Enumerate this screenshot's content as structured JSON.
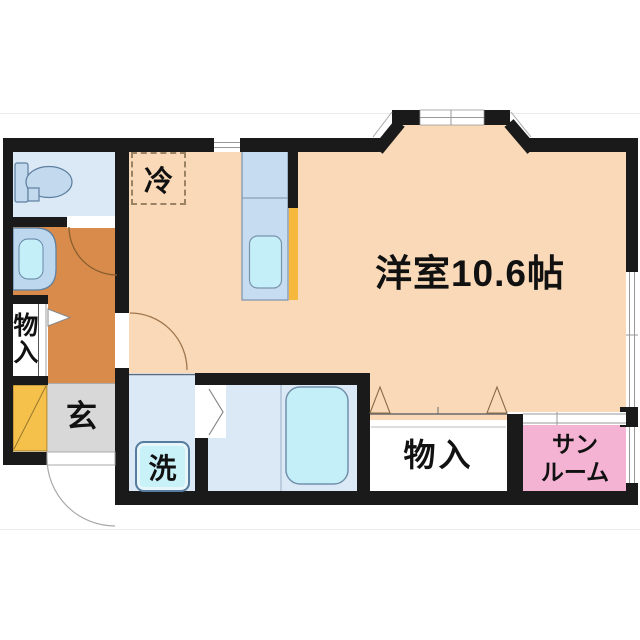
{
  "floorplan": {
    "labels": {
      "main_room": "洋室10.6帖",
      "refrigerator": "冷",
      "storage_left": "物入",
      "genkan": "玄",
      "washing_machine": "洗",
      "storage_bottom": "物入",
      "sunroom_line1": "サン",
      "sunroom_line2": "ルーム"
    },
    "colors": {
      "wall": "#1a1a1a",
      "western_room": "#f9d9b7",
      "hallway": "#d98b4b",
      "wet_room": "#dbe9f7",
      "kitchen_counter": "#c6dcf0",
      "water_cyan": "#c4eff8",
      "genkan_gray": "#d8d8d8",
      "shoe_cabinet_yellow": "#f6c14b",
      "counter_partition_yellow": "#f5b83d",
      "sunroom_pink": "#f4b3d3",
      "storage_white": "#ffffff"
    }
  }
}
